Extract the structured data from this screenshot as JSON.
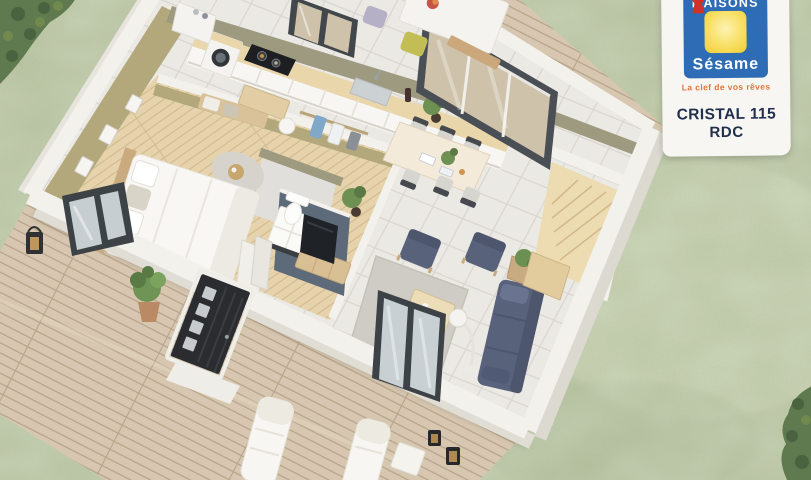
{
  "brand_card": {
    "brand_name_top": "MAISONS",
    "brand_name_bottom": "Sésame",
    "tagline": "La clef de vos rêves",
    "model": "CRISTAL 115",
    "level": "RDC",
    "colors": {
      "logo_blue": "#2e6cb5",
      "logo_yellow": "#f6d44a",
      "keyhole_red": "#d23227",
      "tagline_orange": "#e0763c",
      "text_navy": "#22304e",
      "card_bg": "#f7f6f2"
    }
  },
  "scene": {
    "description": "3D dollhouse floor plan of a single-storey house with wooden deck, garden, bedroom, kitchen, living-dining room, WC and staircase",
    "colors": {
      "grass": "#b7c2a0",
      "grass_light": "#cdd7b6",
      "hedge": "#5f7a4e",
      "deck": "#d7c7b0",
      "deck_line": "#b7a48a",
      "wall": "#f3f1ec",
      "wall_face": "#e0ddd5",
      "interior_wall_olive": "#9e9a80",
      "bedroom_wallpaper": "#b3a87c",
      "wood_floor": "#e7d3ab",
      "tile_floor": "#ebe9e4",
      "slate_wall": "#5d6a79",
      "navy_upholstery": "#59627b",
      "wood_furniture": "#dfc69c",
      "door_dark": "#2a2c30",
      "stair_wood": "#eddbb2",
      "window_frame": "#3d4246"
    }
  }
}
